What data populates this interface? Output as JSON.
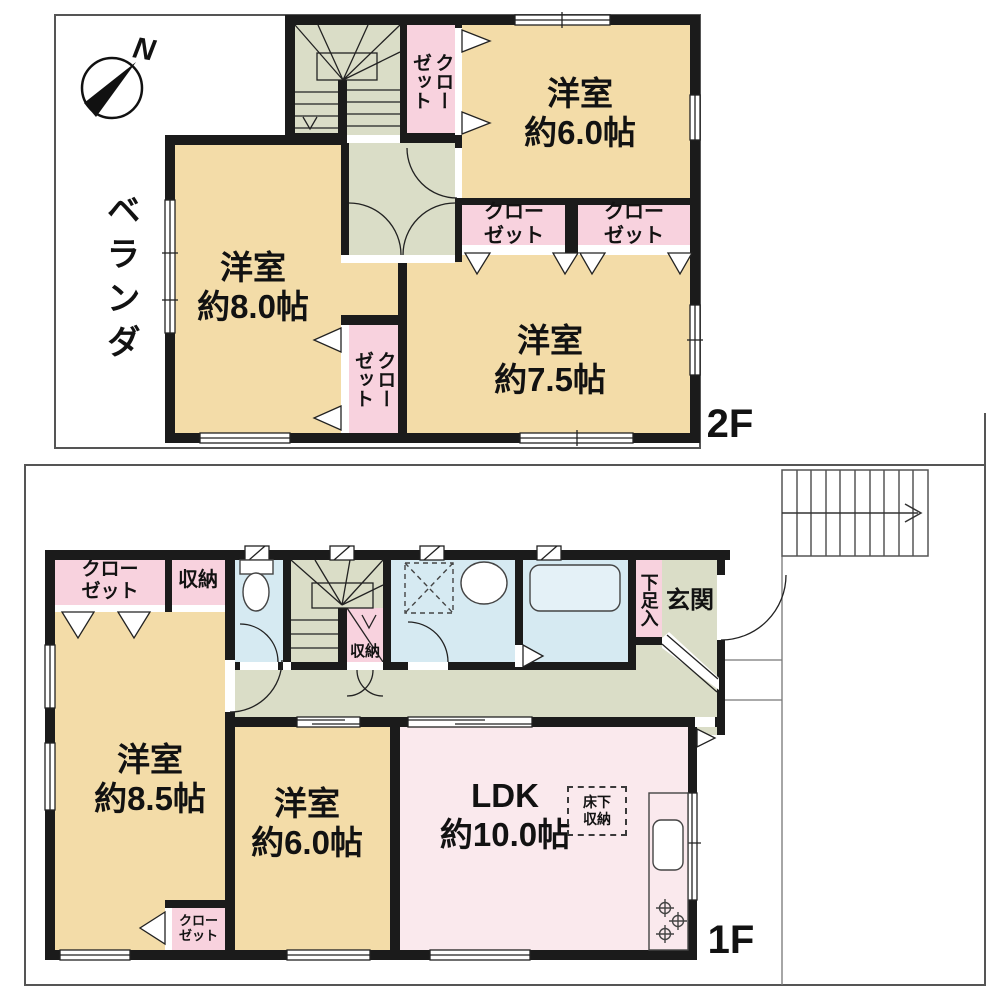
{
  "title": "間取り図（2階建て住宅）",
  "colors": {
    "room_beige": "#F3DCA8",
    "closet_pink": "#F8D2DE",
    "ldk_pink": "#FAE9ED",
    "hall_green": "#DADDC7",
    "wet_area_blue": "#D6EAF2",
    "bathtub_blue": "#E4F1F7",
    "wall_black": "#1B1B1B"
  },
  "floor2": {
    "floor_label": "2F",
    "compass": {
      "north_label": "N"
    },
    "veranda_label": "ベランダ",
    "room_60": "洋室\n約6.0帖",
    "room_80": "洋室\n約8.0帖",
    "room_75": "洋室\n約7.5帖",
    "closet_upper": "クロー\nゼット",
    "closet_mid_left": "クロー\nゼット",
    "closet_mid_right": "クロー\nゼット",
    "closet_lower": "クロー\nゼット"
  },
  "floor1": {
    "floor_label": "1F",
    "closet_nw": "クロー\nゼット",
    "storage_nw": "収納",
    "room_85": "洋室\n約8.5帖",
    "room_60": "洋室\n約6.0帖",
    "ldk": "LDK\n約10.0帖",
    "stair_storage": "収納",
    "shoe_storage": "下足入",
    "entrance": "玄関",
    "underfloor_storage": "床下\n収納",
    "closet_sw": "クロー\nゼット"
  }
}
